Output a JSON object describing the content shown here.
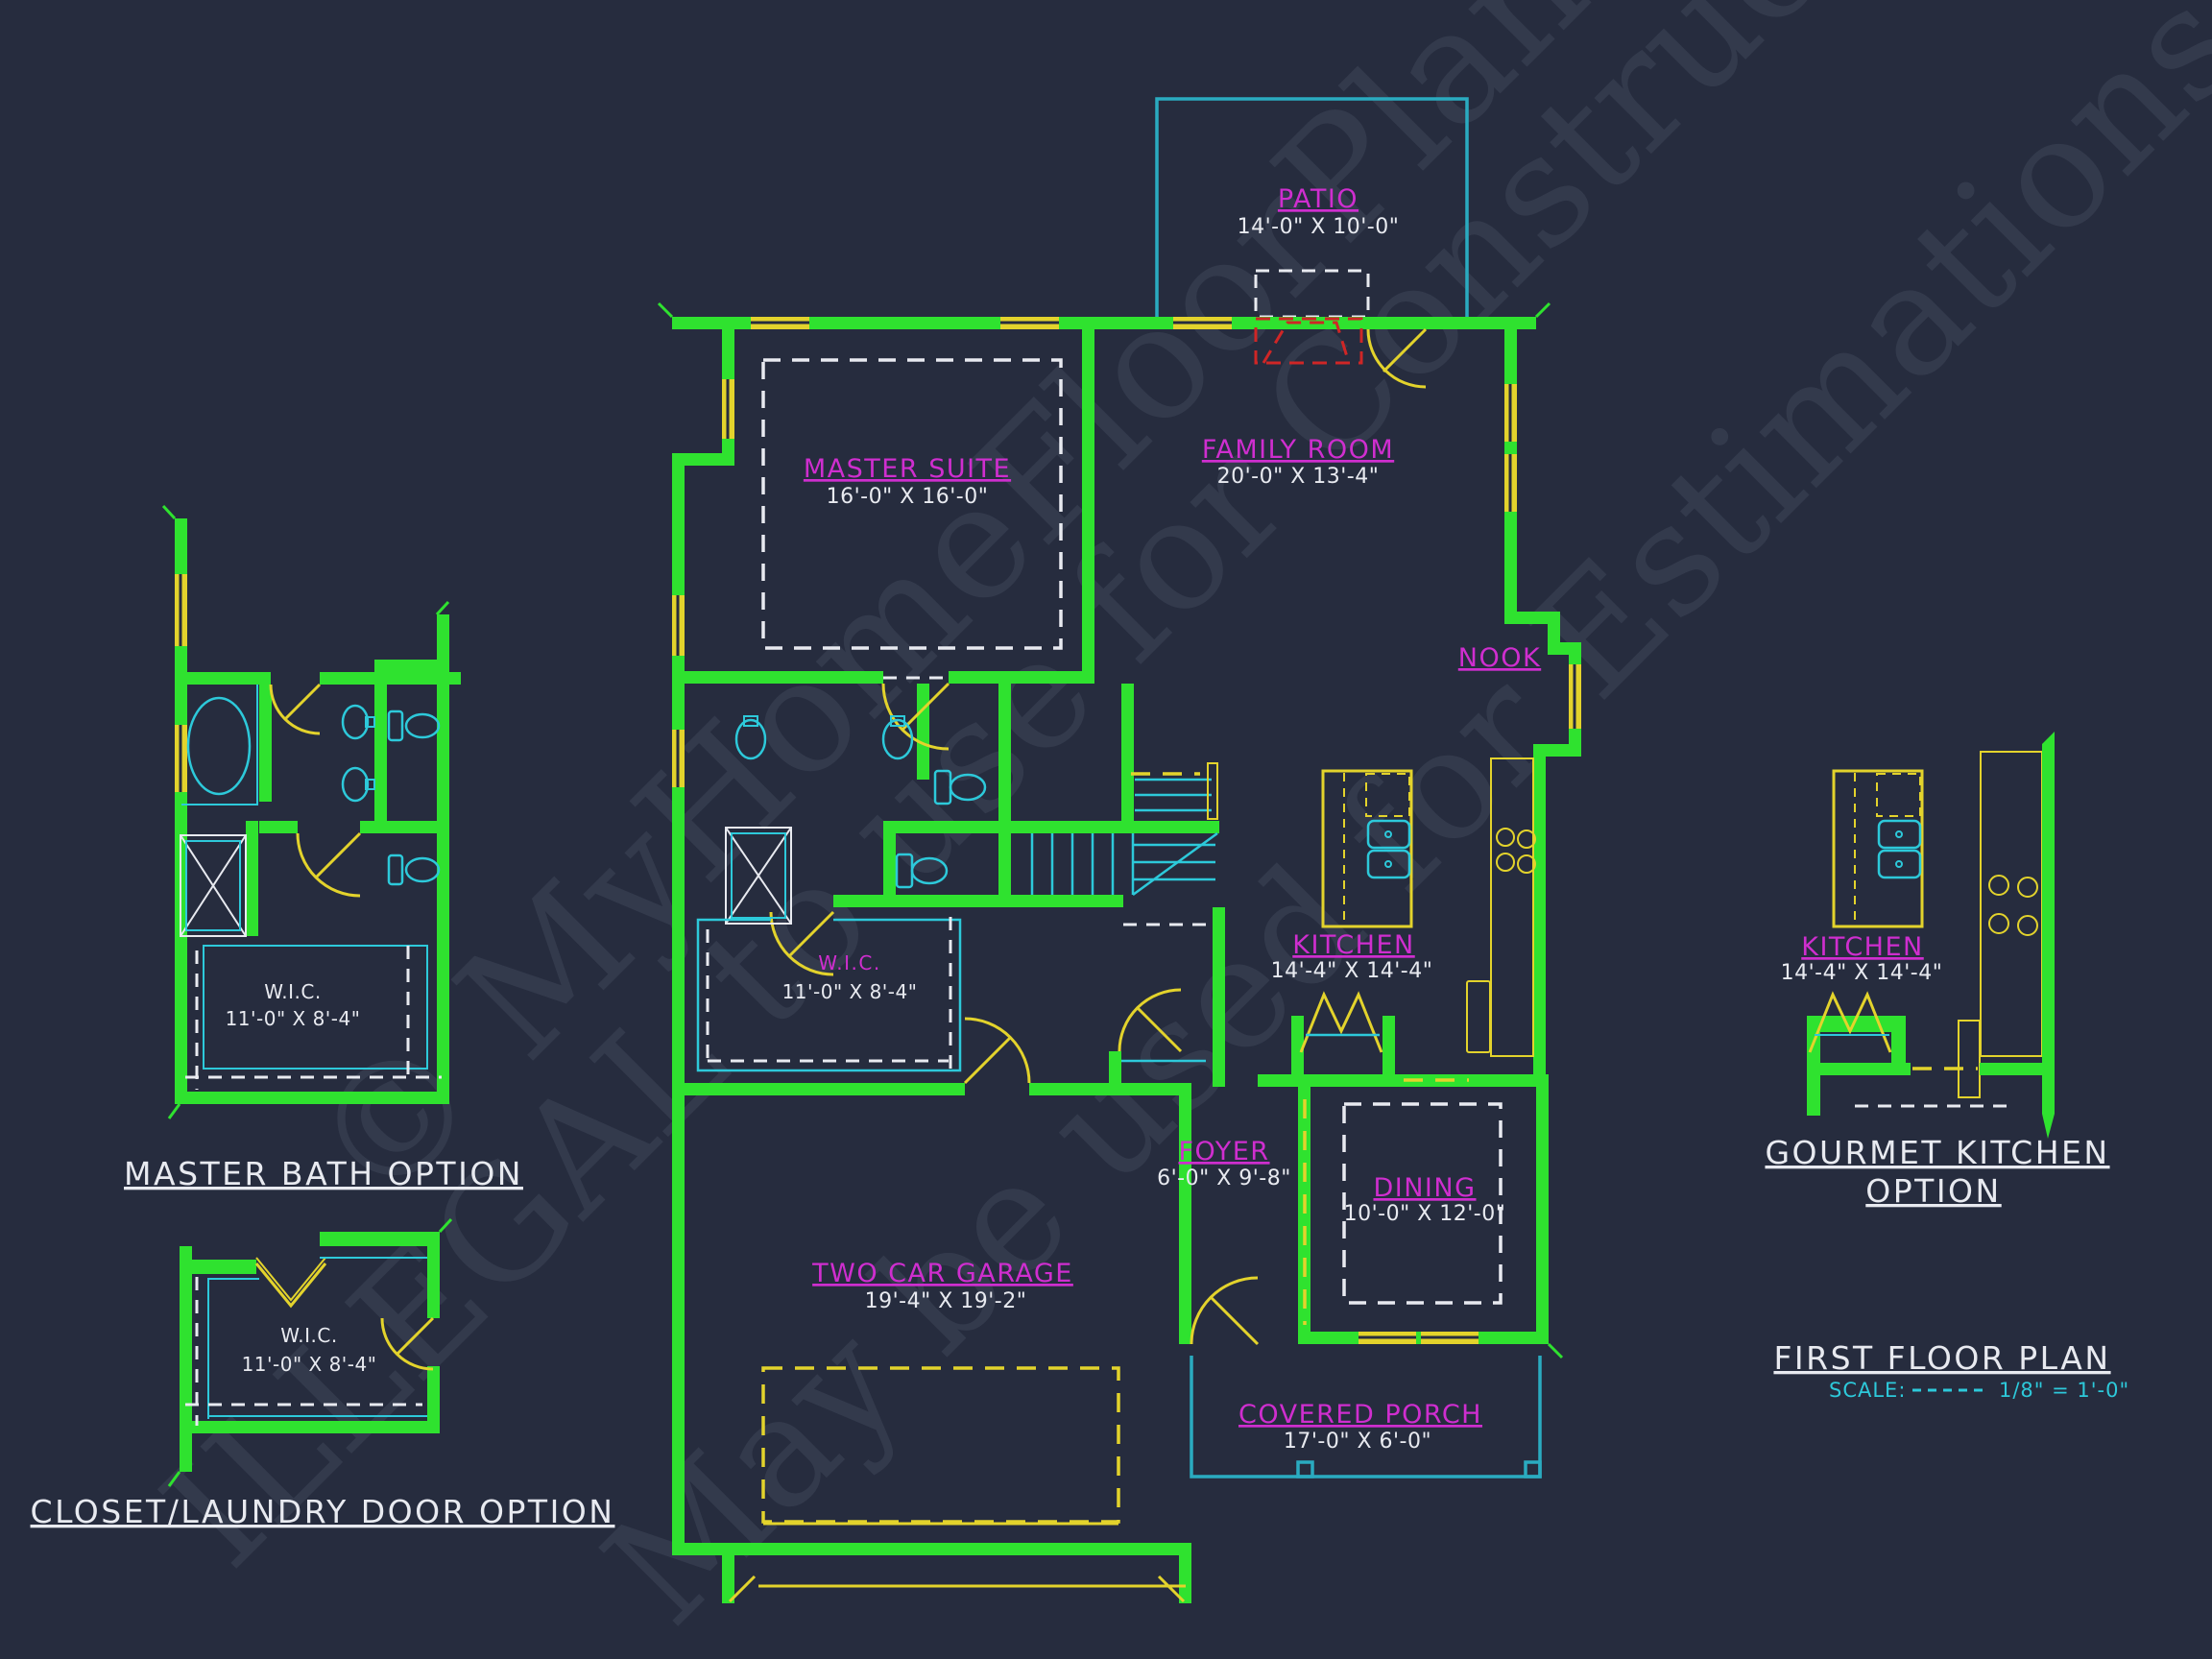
{
  "colors": {
    "background": "#262c3e",
    "walls": "#2fe22f",
    "trim": "#e3d32c",
    "fixtures": "#2dc9da",
    "porch": "#2aabc0",
    "labels": "#cf2ecf",
    "dashed": "#e8eaf0",
    "fireplace": "#cf2626",
    "scale_text": "#2dc9da",
    "watermark": "#a7b4cc"
  },
  "watermark": {
    "line1": "© MyHomeFloorPlans.com",
    "line2": "ILLEGAL to use for Construction",
    "line3": "May be used for Estimations"
  },
  "rooms": {
    "patio": {
      "name": "PATIO",
      "dim": "14'-0\" X 10'-0\""
    },
    "master_suite": {
      "name": "MASTER SUITE",
      "dim": "16'-0\" X 16'-0\""
    },
    "family_room": {
      "name": "FAMILY ROOM",
      "dim": "20'-0\" X 13'-4\""
    },
    "nook": {
      "name": "NOOK"
    },
    "kitchen": {
      "name": "KITCHEN",
      "dim": "14'-4\" X 14'-4\""
    },
    "wic": {
      "name": "W.I.C.",
      "dim": "11'-0\" X 8'-4\""
    },
    "foyer": {
      "name": "FOYER",
      "dim": "6'-0\" X 9'-8\""
    },
    "dining": {
      "name": "DINING",
      "dim": "10'-0\" X 12'-0\""
    },
    "garage": {
      "name": "TWO CAR GARAGE",
      "dim": "19'-4\" X 19'-2\""
    },
    "porch": {
      "name": "COVERED PORCH",
      "dim": "17'-0\" X 6'-0\""
    }
  },
  "options": {
    "master_bath": {
      "title": "MASTER BATH OPTION",
      "wic": {
        "name": "W.I.C.",
        "dim": "11'-0\" X 8'-4\""
      }
    },
    "closet_laundry": {
      "title": "CLOSET/LAUNDRY DOOR OPTION",
      "wic": {
        "name": "W.I.C.",
        "dim": "11'-0\" X 8'-4\""
      }
    },
    "gourmet": {
      "title_line1": "GOURMET KITCHEN",
      "title_line2": "OPTION",
      "kitchen": {
        "name": "KITCHEN",
        "dim": "14'-4\" X 14'-4\""
      }
    }
  },
  "plan_title": {
    "name": "FIRST FLOOR PLAN",
    "scale_label": "SCALE:",
    "scale_value": "1/8\" = 1'-0\""
  }
}
